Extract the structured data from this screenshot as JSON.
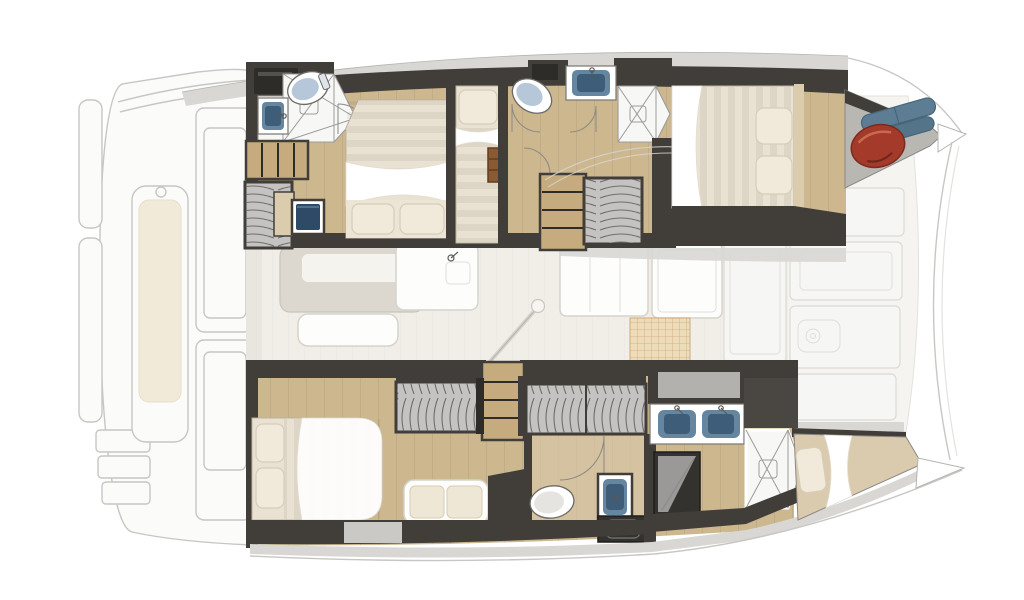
{
  "canvas": {
    "width": 1024,
    "height": 600,
    "viewBox": "0 0 1024 600",
    "background": "#ffffff"
  },
  "colors": {
    "bg": "#ffffff",
    "ghost_line": "#c7c6c3",
    "ghost_fill": "#fbfbfa",
    "ghost_panel": "#f6f6f4",
    "ghost_cushion": "#f1ead9",
    "gunwale": "#d8d7d4",
    "gunwale_edge": "#b4b3b0",
    "wall_dark": "#413e3a",
    "wall_darker": "#2e2c29",
    "wood": "#ccb78f",
    "wood_light": "#dcccae",
    "wood_line": "#00000017",
    "step_wood": "#c5ab7e",
    "bed_base": "#e9e1d1",
    "bed_stripe": "#0000000d",
    "pillow": "#f1eadb",
    "pillow_shadow": "#d6cdb9",
    "bench_cushion": "#efe7d5",
    "wardrobe_bg": "#c4c3c1",
    "wardrobe_line": "#6f6e6b",
    "shower_bg": "#f7f7f5",
    "shower_line": "#9d9c99",
    "fixture_line": "#787672",
    "sink_blue": "#66869f",
    "sink_blue_dark": "#3e5d78",
    "toilet_seat": "#b5c7d8",
    "toilet_seat_plain": "#e6e4e0",
    "appliance_dark": "#34322e",
    "fender_red": "#a43a2a",
    "fender_red_dark": "#7c2a1e",
    "fender_red_hi": "#c96a50",
    "fender_blue": "#5c7d94",
    "fender_blue_dark": "#47657a",
    "saloon_floor": "#f1eee8",
    "saloon_line": "#0000000a",
    "furn_line": "#d7d3cc",
    "furn_fill": "#fdfdfc",
    "table": "#dcd8d0",
    "table_inset": "#f5f3ee",
    "stove": "#ecdcba",
    "stove_line": "#cfa87a",
    "forepeak_floor": "#b9b7b2",
    "deck_white": "#f5f4f1",
    "berth_tan": "#dbcbae",
    "metal": "#5a5955"
  },
  "floorplan": {
    "type": "catamaran-yacht-deck-plan",
    "view": "top-down",
    "bow_direction": "right",
    "stern_direction": "left",
    "zones": {
      "aft_cockpit": [
        "transom-platforms",
        "swim-steps",
        "cockpit-bench-with-cushion",
        "helm-consoles",
        "cockpit-roof-edge"
      ],
      "saloon": [
        "dining-table",
        "saloon-bench",
        "galley-island-with-faucet",
        "galley-counters",
        "stove",
        "fridge-cabinets",
        "mast-post",
        "mainsheet-line"
      ],
      "hull_top": {
        "aft_cabin": [
          "double-bed",
          "two-pillows",
          "white-throw",
          "toilet",
          "shower-pan",
          "sink",
          "steps",
          "wardrobe",
          "vanity-unit"
        ],
        "bunk_cabin": [
          "single-berth",
          "pillow",
          "wood-ladder"
        ],
        "mid_bathroom": [
          "toilet",
          "sink",
          "shower-pan",
          "stairs",
          "wardrobe"
        ],
        "forward_cabin": [
          "double-bed",
          "two-pillows",
          "white-throw"
        ],
        "forepeak_locker": [
          "red-fender",
          "blue-fenders"
        ]
      },
      "hull_bottom": {
        "aft_cabin": [
          "double-bed",
          "two-pillows",
          "white-throw",
          "wardrobe",
          "bench-with-two-cushions"
        ],
        "mid_area": [
          "stairs",
          "wardrobe",
          "toilet",
          "sink",
          "washer-appliance"
        ],
        "forward_bathroom": [
          "double-sink-vanity",
          "shower-pan",
          "dark-shower-stall"
        ],
        "forepeak_berth": [
          "mattress",
          "pillow",
          "white-sheet"
        ]
      },
      "foredeck": [
        "sunpad-panels",
        "deck-hatch",
        "crossbeam-arc",
        "bow-tips"
      ]
    },
    "counts": {
      "double_beds": 3,
      "single_berths": 2,
      "toilets": 3,
      "sink_bowls": 5,
      "shower_pans": 3,
      "wardrobes": 4,
      "stair_sets": 3,
      "fenders": 3
    }
  }
}
